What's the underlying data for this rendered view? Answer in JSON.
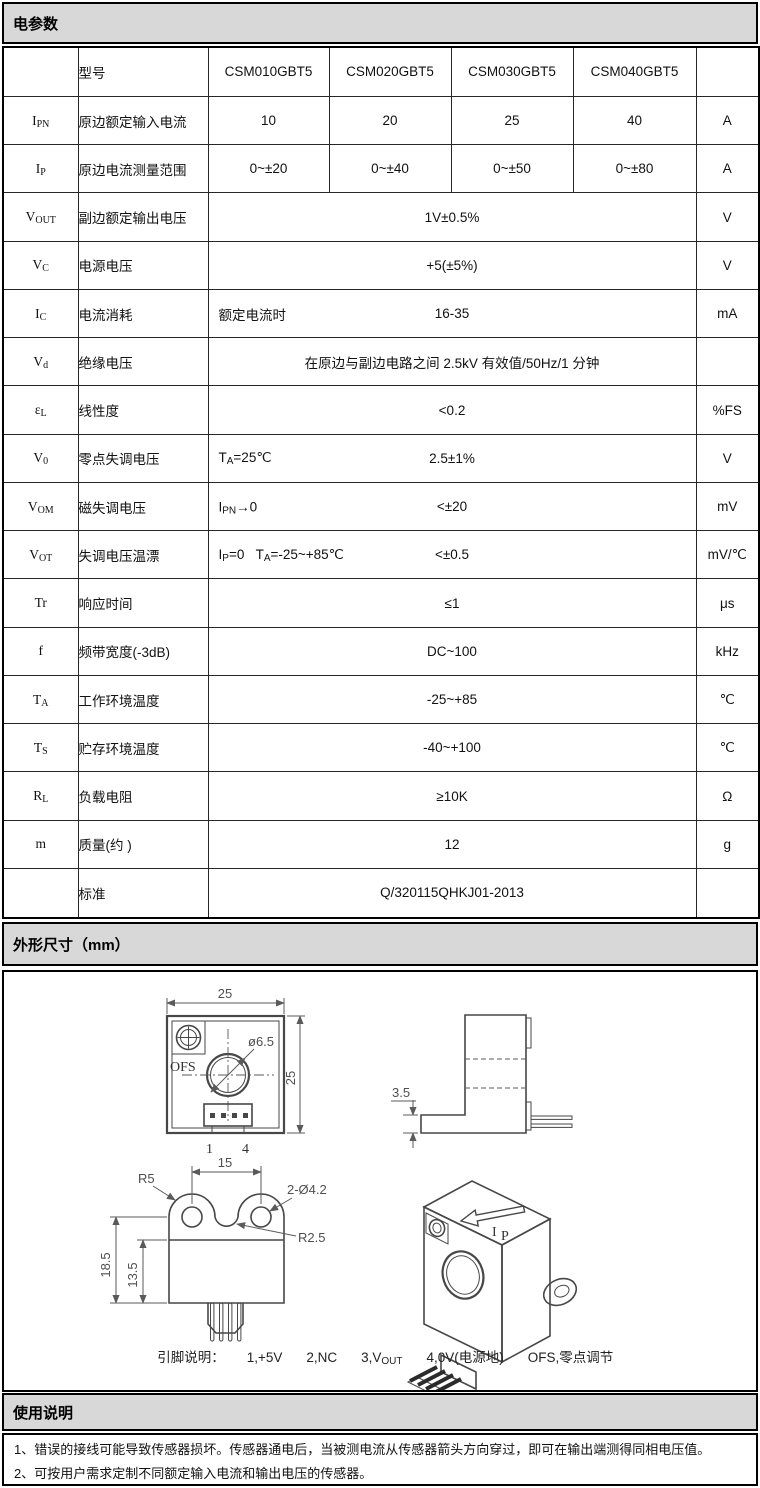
{
  "colors": {
    "band_bg": "#d8d8d8",
    "border": "#000000",
    "drawing_line": "#474747"
  },
  "sections": {
    "electrical": {
      "title": "电参数"
    },
    "dimensions": {
      "title": "外形尺寸（mm）"
    },
    "usage": {
      "title": "使用说明"
    }
  },
  "table": {
    "header": {
      "model_label": "型号",
      "models": [
        "CSM010GBT5",
        "CSM020GBT5",
        "CSM030GBT5",
        "CSM040GBT5"
      ]
    },
    "rows": [
      {
        "sym": [
          [
            "t",
            "I"
          ],
          [
            "s",
            "PN"
          ]
        ],
        "param": "原边额定输入电流",
        "values": [
          "10",
          "20",
          "25",
          "40"
        ],
        "unit": "A"
      },
      {
        "sym": [
          [
            "t",
            "I"
          ],
          [
            "s",
            "P"
          ]
        ],
        "param": "原边电流测量范围",
        "values": [
          "0~±20",
          "0~±40",
          "0~±50",
          "0~±80"
        ],
        "unit": "A"
      },
      {
        "sym": [
          [
            "t",
            "V"
          ],
          [
            "s",
            "OUT"
          ]
        ],
        "param": "副边额定输出电压",
        "merged": [
          [
            "t",
            "1V±0.5%"
          ]
        ],
        "unit": "V"
      },
      {
        "sym": [
          [
            "t",
            "V"
          ],
          [
            "s",
            "C"
          ]
        ],
        "param": "电源电压",
        "merged": [
          [
            "t",
            "+5(±5%)"
          ]
        ],
        "unit": "V"
      },
      {
        "sym": [
          [
            "t",
            "I"
          ],
          [
            "s",
            "C"
          ]
        ],
        "param": "电流消耗",
        "condition": [
          [
            "t",
            "额定电流时"
          ]
        ],
        "merged": [
          [
            "t",
            "16-35"
          ]
        ],
        "unit": "mA"
      },
      {
        "sym": [
          [
            "t",
            "V"
          ],
          [
            "s",
            "d"
          ]
        ],
        "param": "绝缘电压",
        "merged": [
          [
            "t",
            "在原边与副边电路之间 2.5kV 有效值/50Hz/1 分钟"
          ]
        ],
        "unit": ""
      },
      {
        "sym": [
          [
            "t",
            "ε"
          ],
          [
            "s",
            "L"
          ]
        ],
        "param": "线性度",
        "merged": [
          [
            "t",
            "<0.2"
          ]
        ],
        "unit": "%FS"
      },
      {
        "sym": [
          [
            "t",
            "V"
          ],
          [
            "s",
            "0"
          ]
        ],
        "param": "零点失调电压",
        "condition": [
          [
            "t",
            "T"
          ],
          [
            "s",
            "A"
          ],
          [
            "t",
            "=25℃"
          ]
        ],
        "merged": [
          [
            "t",
            "2.5±1%"
          ]
        ],
        "unit": "V"
      },
      {
        "sym": [
          [
            "t",
            "V"
          ],
          [
            "s",
            "OM"
          ]
        ],
        "param": "磁失调电压",
        "condition": [
          [
            "t",
            "I"
          ],
          [
            "s",
            "PN"
          ],
          [
            "t",
            "→0"
          ]
        ],
        "merged": [
          [
            "t",
            "<±20"
          ]
        ],
        "unit": "mV"
      },
      {
        "sym": [
          [
            "t",
            "V"
          ],
          [
            "s",
            "OT"
          ]
        ],
        "param": "失调电压温漂",
        "condition": [
          [
            "t",
            "I"
          ],
          [
            "s",
            "P"
          ],
          [
            "t",
            "=0   T"
          ],
          [
            "s",
            "A"
          ],
          [
            "t",
            "=-25~+85℃"
          ]
        ],
        "merged": [
          [
            "t",
            "<±0.5"
          ]
        ],
        "unit": "mV/℃"
      },
      {
        "sym": [
          [
            "t",
            "Tr"
          ]
        ],
        "param": "响应时间",
        "merged": [
          [
            "t",
            "≤1"
          ]
        ],
        "unit": "μs"
      },
      {
        "sym": [
          [
            "t",
            "f"
          ]
        ],
        "param": "频带宽度(-3dB)",
        "merged": [
          [
            "t",
            "DC~100"
          ]
        ],
        "unit": "kHz"
      },
      {
        "sym": [
          [
            "t",
            "T"
          ],
          [
            "s",
            "A"
          ]
        ],
        "param": "工作环境温度",
        "merged": [
          [
            "t",
            "-25~+85"
          ]
        ],
        "unit": "℃"
      },
      {
        "sym": [
          [
            "t",
            "T"
          ],
          [
            "s",
            "S"
          ]
        ],
        "param": "贮存环境温度",
        "merged": [
          [
            "t",
            "-40~+100"
          ]
        ],
        "unit": "℃"
      },
      {
        "sym": [
          [
            "t",
            "R"
          ],
          [
            "s",
            "L"
          ]
        ],
        "param": "负载电阻",
        "merged": [
          [
            "t",
            "≥10K"
          ]
        ],
        "unit": "Ω"
      },
      {
        "sym": [
          [
            "t",
            "m"
          ]
        ],
        "param": "质量(约 )",
        "merged": [
          [
            "t",
            "12"
          ]
        ],
        "unit": "g"
      },
      {
        "sym": [],
        "param": "标准",
        "merged": [
          [
            "t",
            "Q/320115QHKJ01-2013"
          ]
        ],
        "unit": ""
      }
    ]
  },
  "drawings": {
    "front": {
      "dim_width": "25",
      "dim_height": "25",
      "hole_label": "ø6.5",
      "ofs_label": "OFS",
      "pin_first": "1",
      "pin_last": "4"
    },
    "side": {
      "dim_offset": "3.5"
    },
    "bottom": {
      "dim_pitch": "15",
      "radius_label": "R5",
      "holes_label": "2-Ø4.2",
      "notch_label": "R2.5",
      "dim_height_outer": "18.5",
      "dim_height_body": "13.5"
    },
    "iso": {
      "current_label_main": "I",
      "current_label_sub": "P"
    },
    "pin_note": {
      "label": "引脚说明：",
      "items": [
        [
          [
            "t",
            "1,+5V"
          ]
        ],
        [
          [
            "t",
            "2,NC"
          ]
        ],
        [
          [
            "t",
            "3,V"
          ],
          [
            "s",
            "OUT"
          ]
        ],
        [
          [
            "t",
            "4,0V(电源地)"
          ]
        ],
        [
          [
            "t",
            "OFS,零点调节"
          ]
        ]
      ]
    }
  },
  "usage_notes": [
    "1、错误的接线可能导致传感器损坏。传感器通电后，当被测电流从传感器箭头方向穿过，即可在输出端测得同相电压值。",
    "2、可按用户需求定制不同额定输入电流和输出电压的传感器。"
  ]
}
